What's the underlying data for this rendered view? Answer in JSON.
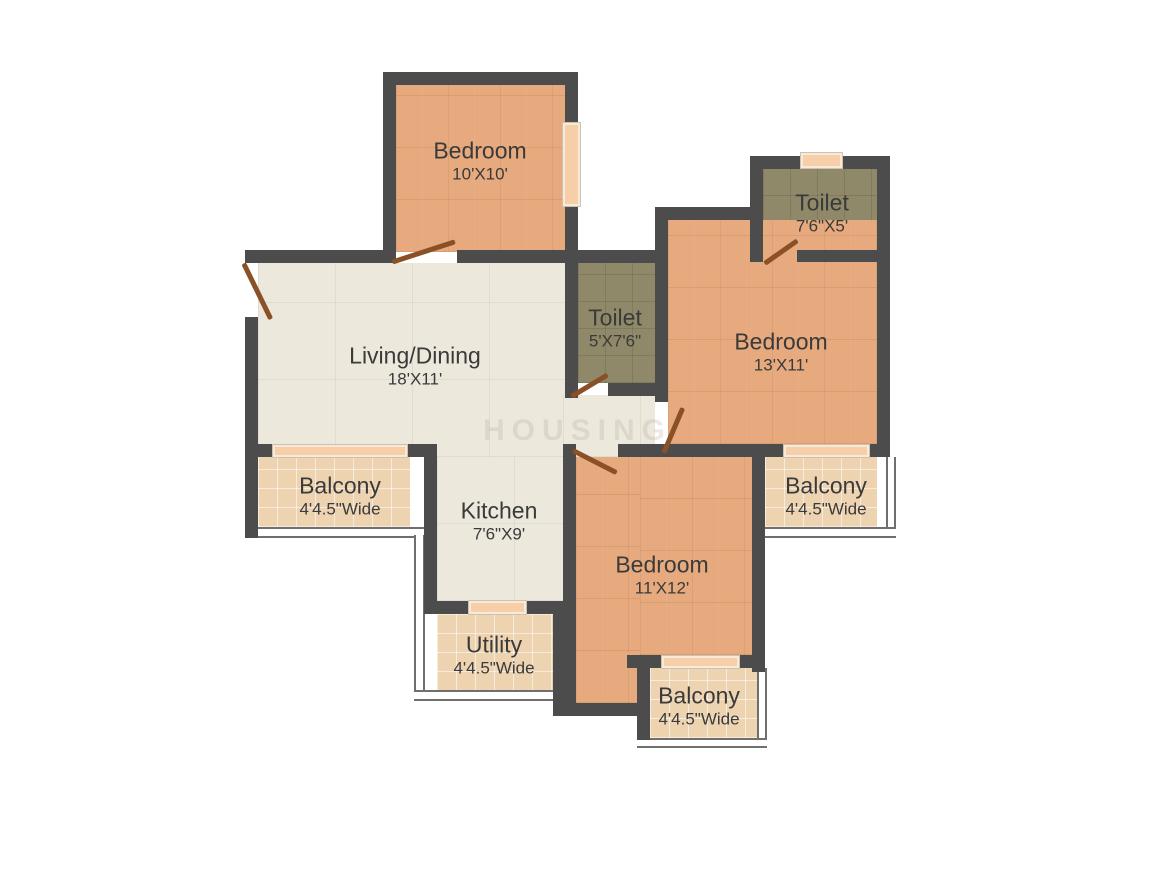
{
  "title": "2BHK-style apartment floor plan",
  "watermark": "HOUSING",
  "rooms": {
    "bedroom_top": {
      "name": "Bedroom",
      "dims": "10'X10'"
    },
    "toilet_top_right": {
      "name": "Toilet",
      "dims": "7'6\"X5'"
    },
    "bedroom_right": {
      "name": "Bedroom",
      "dims": "13'X11'"
    },
    "toilet_middle": {
      "name": "Toilet",
      "dims": "5'X7'6\""
    },
    "living_dining": {
      "name": "Living/Dining",
      "dims": "18'X11'"
    },
    "balcony_left": {
      "name": "Balcony",
      "dims": "4'4.5\"Wide"
    },
    "kitchen": {
      "name": "Kitchen",
      "dims": "7'6\"X9'"
    },
    "balcony_right": {
      "name": "Balcony",
      "dims": "4'4.5\"Wide"
    },
    "bedroom_bottom": {
      "name": "Bedroom",
      "dims": "11'X12'"
    },
    "utility": {
      "name": "Utility",
      "dims": "4'4.5\"Wide"
    },
    "balcony_bottom": {
      "name": "Balcony",
      "dims": "4'4.5\"Wide"
    }
  },
  "colors": {
    "wall": "#4c4c4c",
    "bedroom_floor": "#e6aa7e",
    "toilet_floor": "#8f8969",
    "living_floor": "#ece8dc",
    "balcony_floor": "#eed3b1",
    "window": "#f6cfa8",
    "door_leaf": "#8a5126",
    "label_text": "#3a3a3a",
    "background": "#ffffff"
  }
}
